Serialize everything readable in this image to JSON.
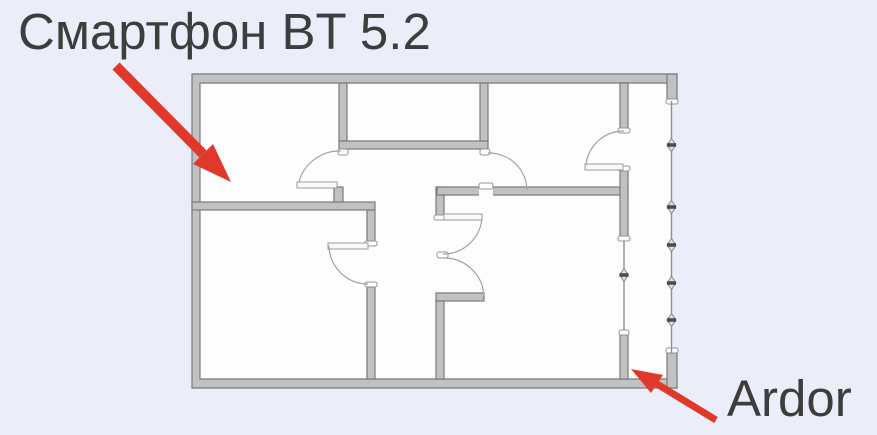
{
  "labels": {
    "smartphone": "Смартфон BT 5.2",
    "ardor": "Ardor"
  },
  "annotations": [
    {
      "text": "Смартфон BT 5.2",
      "arrow": "red",
      "points_to": "top-left-room"
    },
    {
      "text": "Ardor",
      "arrow": "red",
      "points_to": "bottom-right-balcony-corner"
    }
  ],
  "diagram": {
    "kind": "apartment-floor-plan"
  },
  "colors": {
    "background": "#ebeef8",
    "plan_interior": "#fdfdfd",
    "wall_fill": "#c1c1c1",
    "wall_stroke": "#7a7a7a",
    "thin_line": "#8f8f8f",
    "arrow_red": "#e0392b",
    "text": "#3d3d3d"
  }
}
